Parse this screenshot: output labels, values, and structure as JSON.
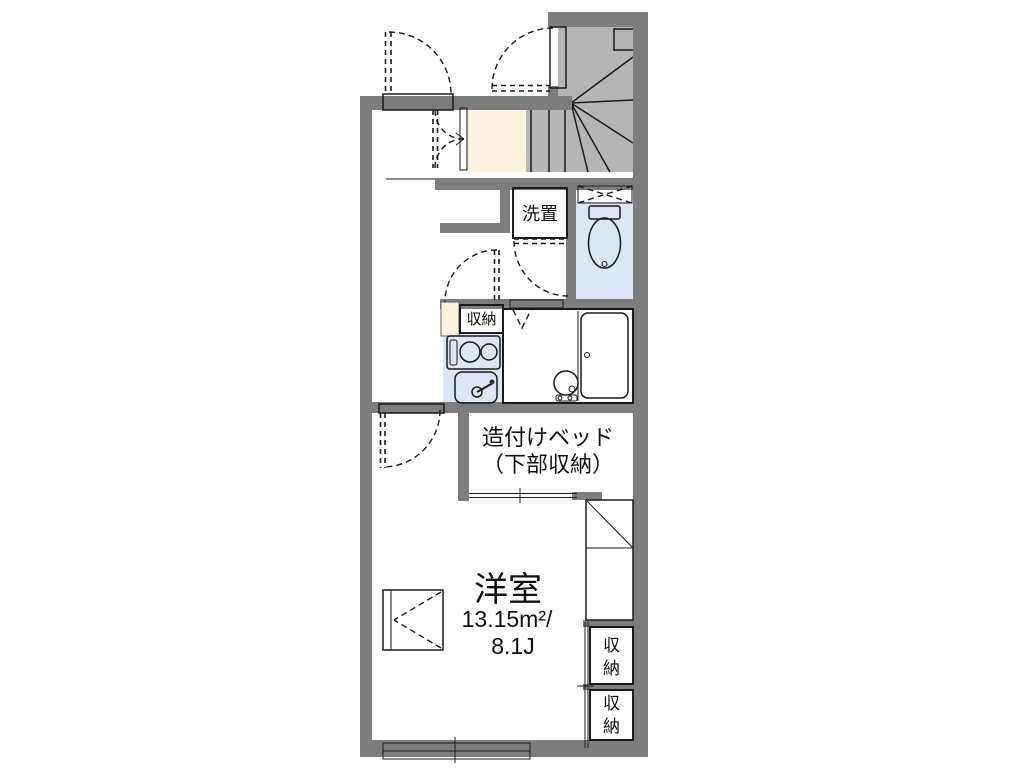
{
  "plan": {
    "type": "floor-plan",
    "labels": {
      "washer": "洗置",
      "kitchen_storage": "収納",
      "bed_line1": "造付けベッド",
      "bed_line2": "（下部収納）",
      "room_name": "洋室",
      "room_area": "13.15m²/",
      "room_tatami": "8.1J",
      "closet_upper": "収納",
      "closet_lower": "収納"
    },
    "rooms": [
      {
        "name": "洋室",
        "area_m2": "13.15m²",
        "size_jo": "8.1J"
      },
      {
        "name": "造付けベッド（下部収納）"
      },
      {
        "name": "収納",
        "count": 3
      },
      {
        "name": "洗置"
      }
    ]
  },
  "colors": {
    "wall": "#7d7d7d",
    "stair": "#b5b5b5",
    "wet": "#dce6f5",
    "storage_fill": "#fdf2dd",
    "outline": "#1a1a1a"
  }
}
